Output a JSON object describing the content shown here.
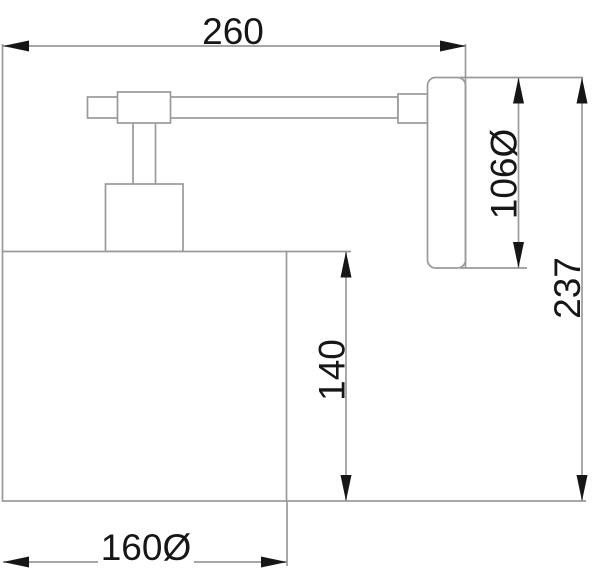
{
  "drawing": {
    "type": "technical-dimension-drawing",
    "subject": "wall-lamp-side-view",
    "colors": {
      "background": "#ffffff",
      "line": "#9a9a9a",
      "ink": "#161616"
    },
    "dimension_labels": {
      "overall_width": "260",
      "backplate_diameter": "106Ø",
      "overall_height": "237",
      "shade_height": "140",
      "shade_diameter": "160Ø"
    }
  }
}
